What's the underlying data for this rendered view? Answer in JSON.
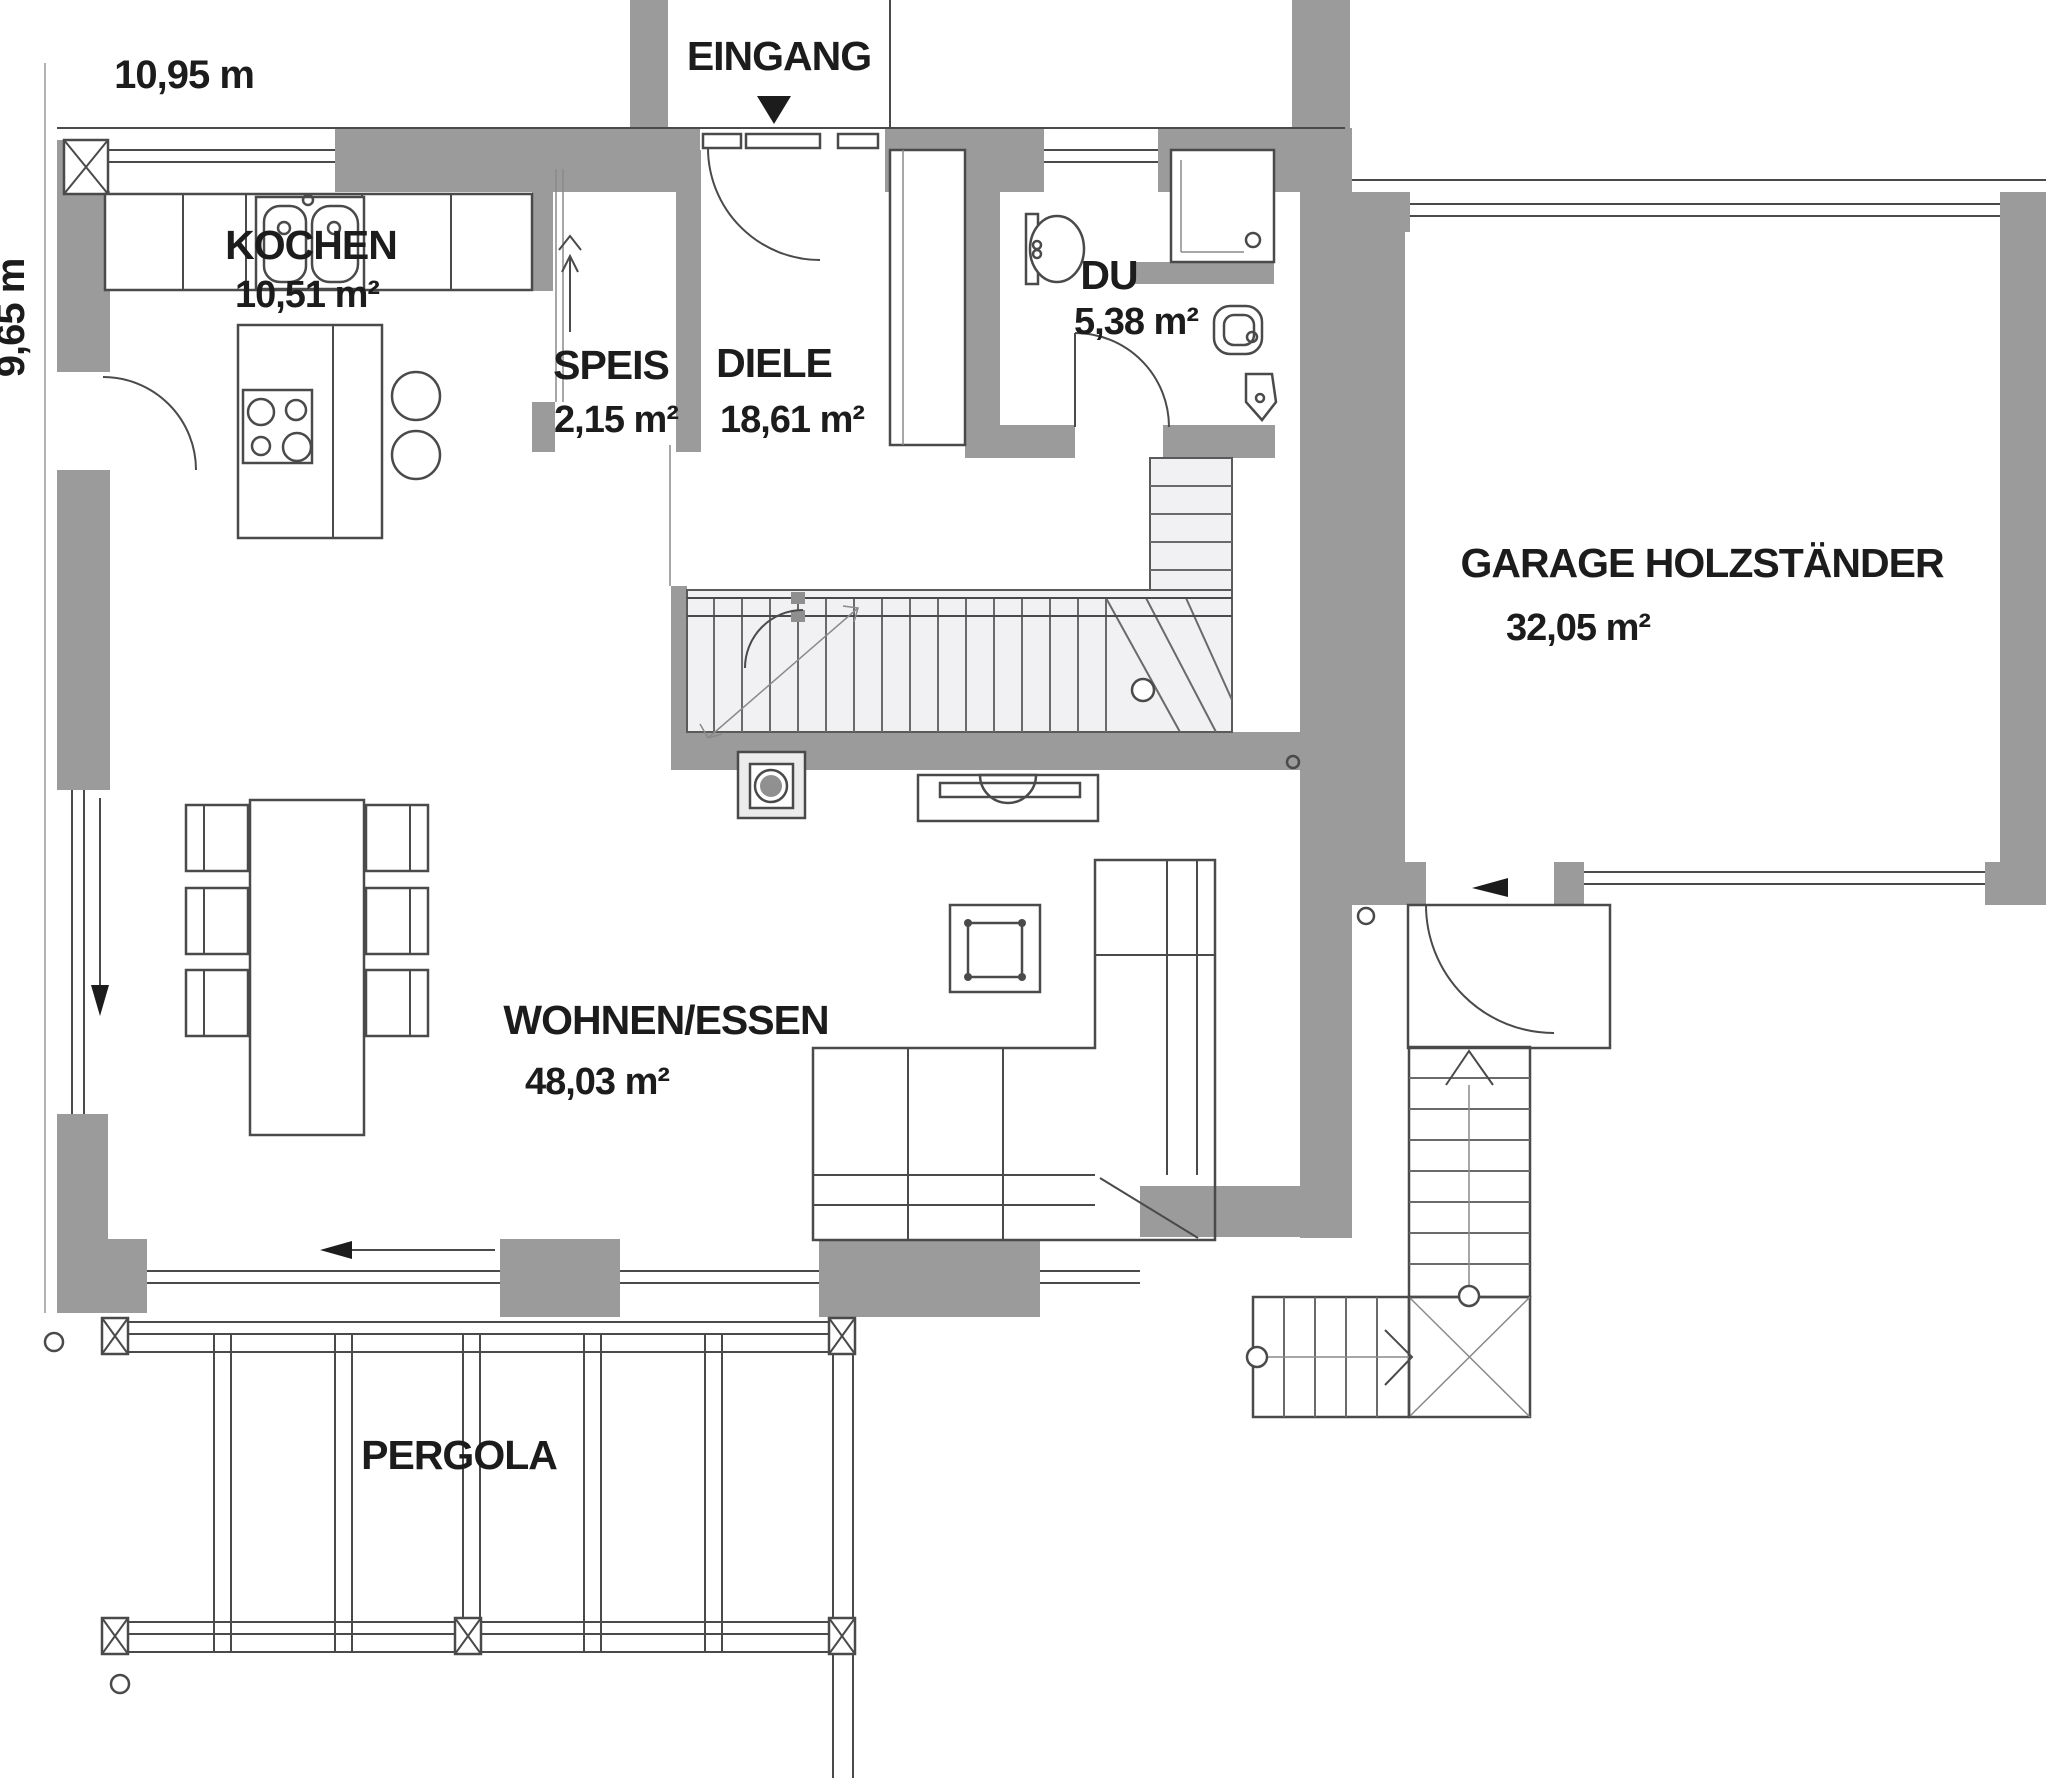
{
  "plan": {
    "type": "floorplan-ground-floor",
    "background": "#ffffff",
    "colors": {
      "wall": "#9b9b9b",
      "line": "#4a4a4a",
      "stair_fill": "#f1f1f4",
      "text": "#1c1c1c",
      "fireplace_disc": "#909090"
    },
    "dimensions": {
      "width_label": "10,95 m",
      "height_label": "9,65 m"
    },
    "entrance": {
      "label": "EINGANG"
    },
    "rooms": [
      {
        "id": "kochen",
        "name": "KOCHEN",
        "area": "10,51 m²"
      },
      {
        "id": "speis",
        "name": "SPEIS",
        "area": "2,15 m²"
      },
      {
        "id": "diele",
        "name": "DIELE",
        "area": "18,61 m²"
      },
      {
        "id": "du",
        "name": "DU",
        "area": "5,38 m²"
      },
      {
        "id": "garage",
        "name": "GARAGE HOLZSTÄNDER",
        "area": "32,05 m²"
      },
      {
        "id": "wohnen-essen",
        "name": "WOHNEN/ESSEN",
        "area": "48,03 m²"
      },
      {
        "id": "pergola",
        "name": "PERGOLA",
        "area": ""
      }
    ]
  }
}
